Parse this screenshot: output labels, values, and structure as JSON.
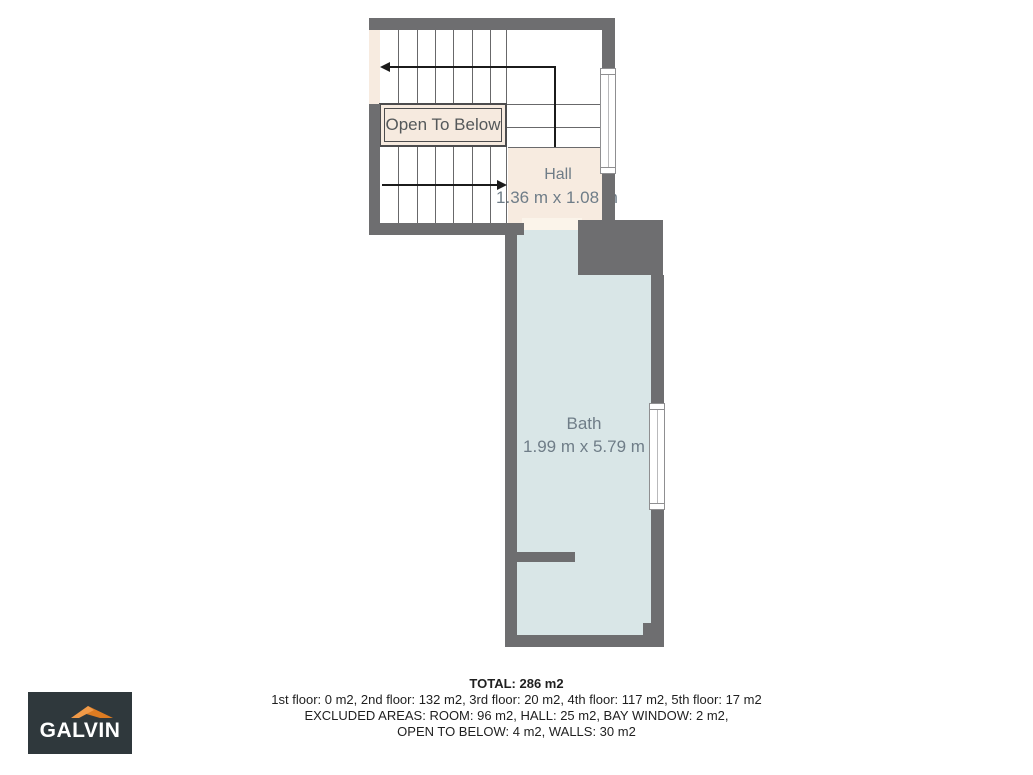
{
  "plan": {
    "open_to_below": "Open To Below",
    "rooms": {
      "hall": {
        "name": "Hall",
        "dims": "1.36 m x 1.08 m"
      },
      "bath": {
        "name": "Bath",
        "dims": "1.99 m x 5.79 m"
      }
    }
  },
  "summary": {
    "total": "TOTAL: 286 m2",
    "floors": "1st floor: 0 m2, 2nd floor: 132 m2, 3rd floor: 20 m2, 4th floor: 117 m2, 5th floor: 17 m2",
    "excluded1": "EXCLUDED AREAS: ROOM: 96 m2, HALL: 25 m2, BAY WINDOW: 2 m2,",
    "excluded2": "OPEN TO BELOW: 4 m2, WALLS: 30 m2"
  },
  "logo": {
    "brand": "GALVIN"
  },
  "colors": {
    "wall": "#6e6e70",
    "hall_floor": "#f7ebe0",
    "bath_floor": "#d9e6e7",
    "threshold": "#fbf4ea",
    "label_text": "#6f7d88",
    "arrow": "#1b1b1b",
    "logo_background": "#2f383c",
    "logo_orange_light": "#f19a48",
    "logo_orange_dark": "#dd7b21"
  }
}
